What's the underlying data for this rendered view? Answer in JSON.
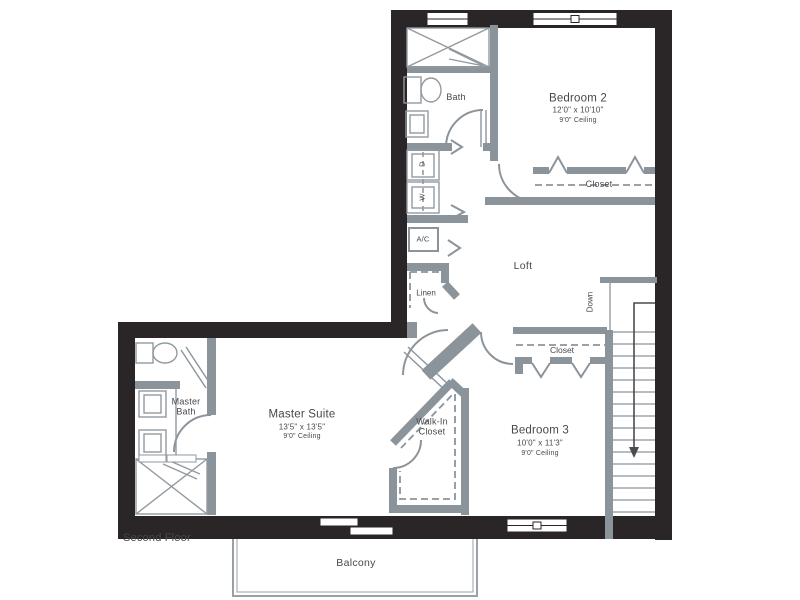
{
  "floor_plan": {
    "floor_label": "Second Floor",
    "colors": {
      "outer_wall": "#2a2627",
      "interior_wall": "#8c949b",
      "fixture_line": "#9199a0",
      "label_text": "#46484c",
      "background": "#ffffff"
    },
    "rooms": {
      "bath": {
        "name": "Bath"
      },
      "bedroom_2": {
        "name": "Bedroom 2",
        "dimensions": "12'0\" x 10'10\"",
        "ceiling": "9'0\" Ceiling"
      },
      "bedroom_2_closet": {
        "name": "Closet"
      },
      "loft": {
        "name": "Loft"
      },
      "ac_closet": {
        "name": "A/C"
      },
      "linen_closet": {
        "name": "Linen"
      },
      "dryer": {
        "name": "D"
      },
      "washer": {
        "name": "W"
      },
      "stairs": {
        "direction_label": "Down"
      },
      "bedroom_3_closet": {
        "name": "Closet"
      },
      "master_bath": {
        "name": "Master Bath"
      },
      "master_suite": {
        "name": "Master Suite",
        "dimensions": "13'5\" x 13'5\"",
        "ceiling": "9'0\" Ceiling"
      },
      "walk_in_closet": {
        "name": "Walk-In Closet"
      },
      "bedroom_3": {
        "name": "Bedroom 3",
        "dimensions": "10'0\" x 11'3\"",
        "ceiling": "9'0\" Ceiling"
      },
      "balcony": {
        "name": "Balcony"
      }
    }
  }
}
